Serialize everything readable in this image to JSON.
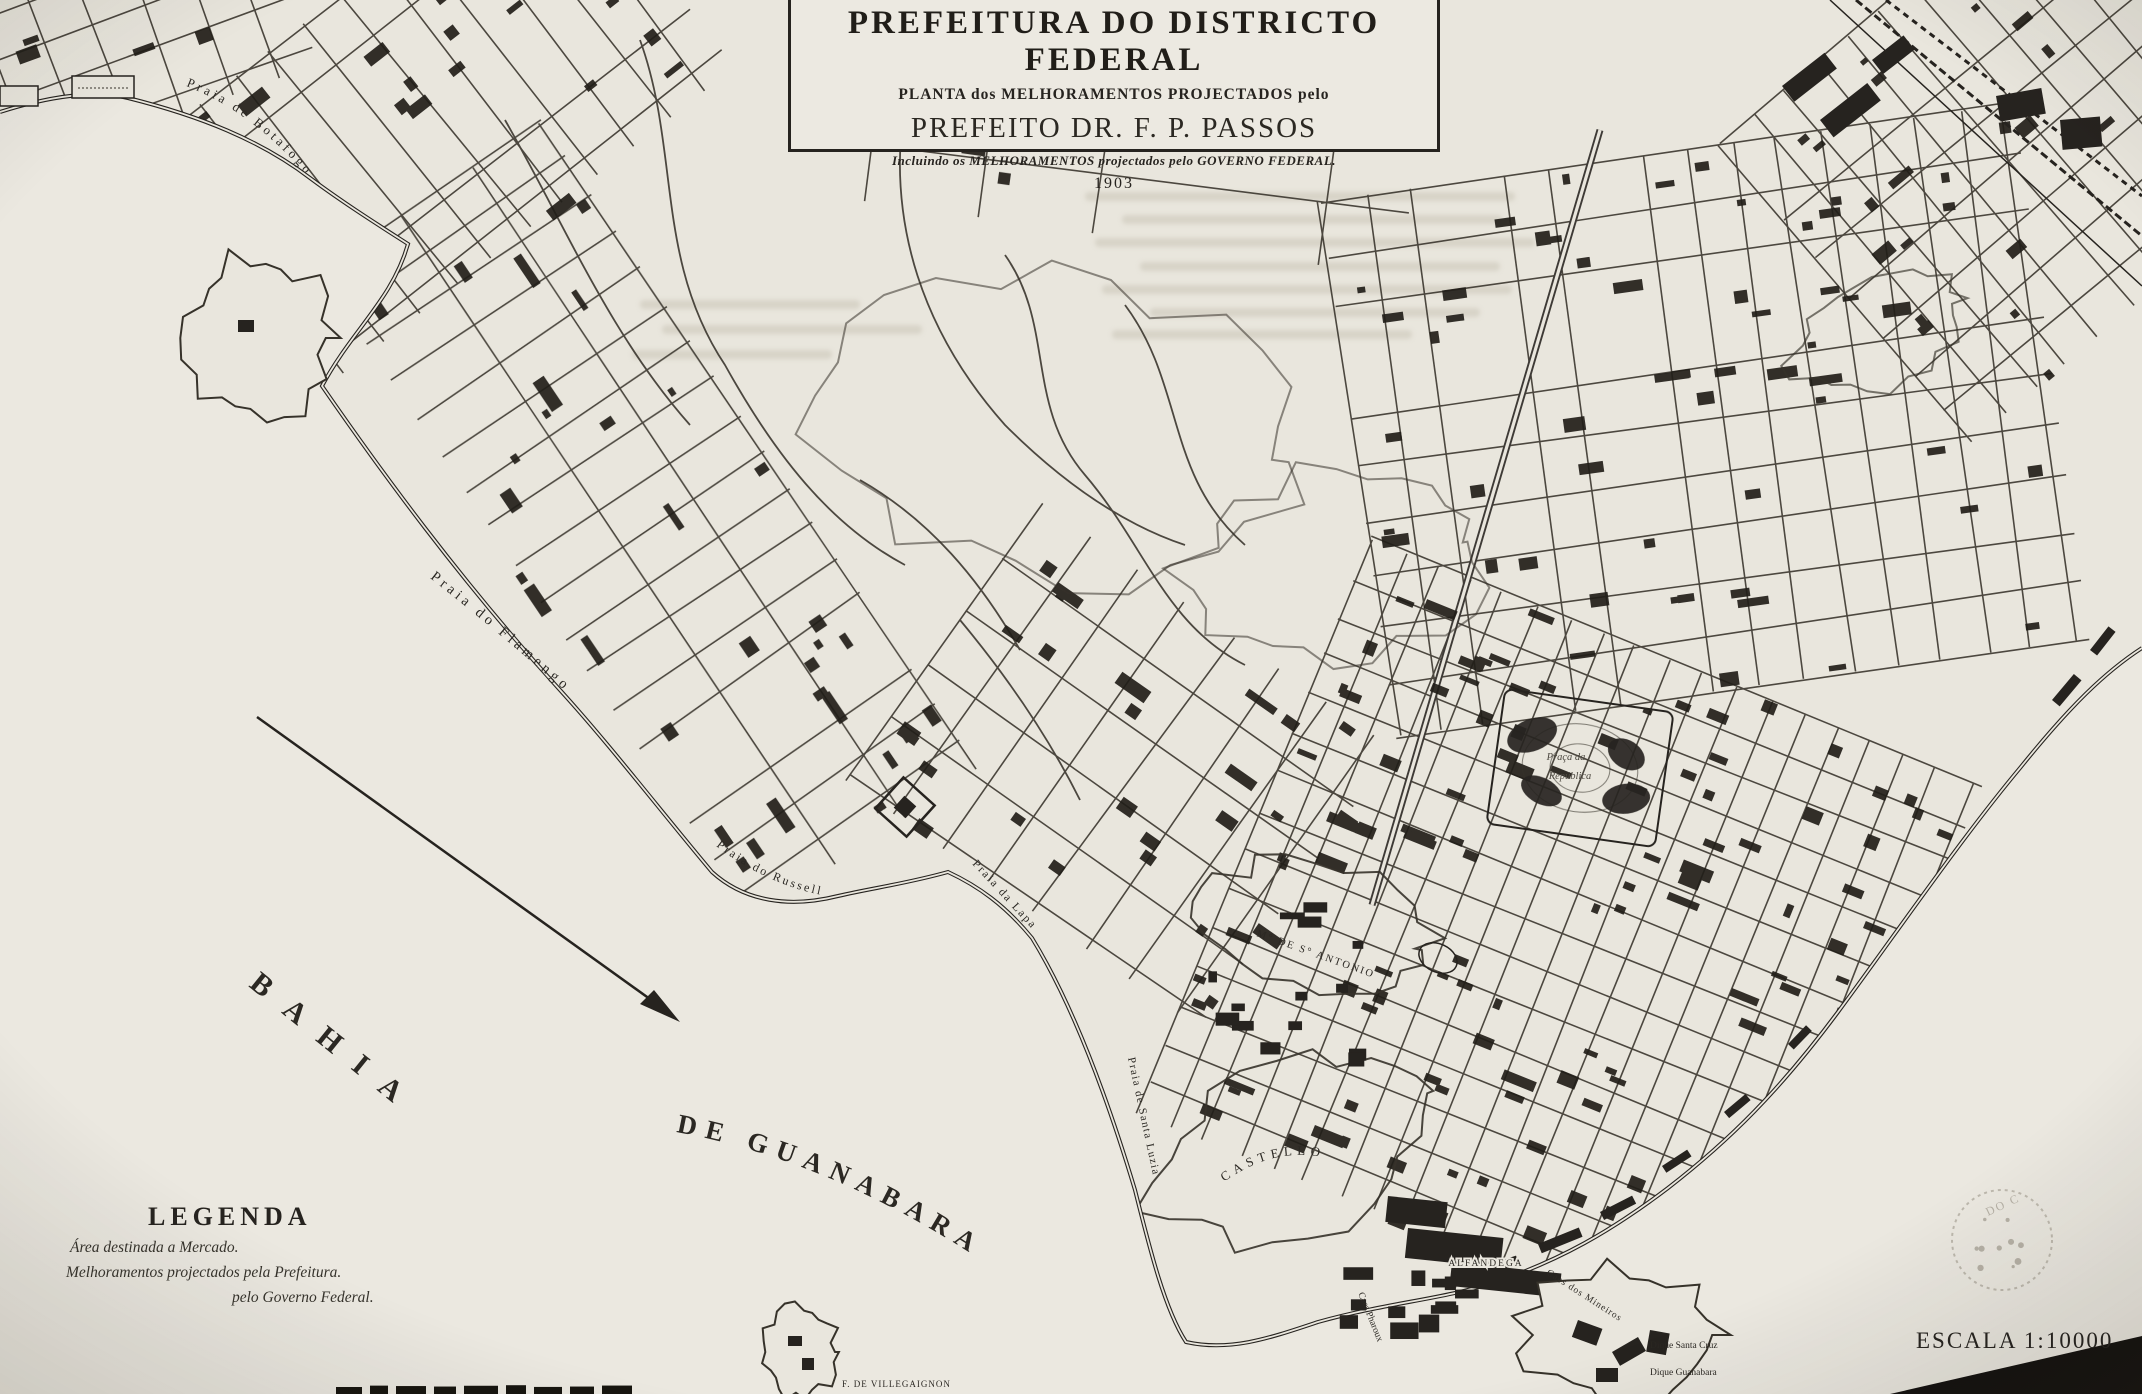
{
  "title_block": {
    "line1": "PREFEITURA DO DISTRICTO FEDERAL",
    "line2": "PLANTA dos MELHORAMENTOS PROJECTADOS pelo",
    "line3": "PREFEITO DR. F. P. PASSOS",
    "line4": "Incluindo os MELHORAMENTOS projectados pelo GOVERNO FEDERAL.",
    "year": "1903"
  },
  "legend": {
    "heading": "LEGENDA",
    "items": [
      "Área destinada a Mercado.",
      "Melhoramentos projectados pela Prefeitura.",
      "pelo Governo Federal."
    ]
  },
  "scale_label": "ESCALA 1:10000",
  "water_labels": [
    {
      "id": "bahia",
      "text": "BAHIA",
      "path": "M 248 986 L 414 1120",
      "size": 30,
      "ls": 22
    },
    {
      "id": "de-guanabara",
      "text": "DE   GUANABARA",
      "path": "M 676 1132 Q 832 1160 990 1266",
      "size": 27,
      "ls": 9
    }
  ],
  "map_labels": [
    {
      "id": "praia-de-botafogo",
      "text": "Praia de Botafogo",
      "path": "M 186 86 Q 280 122 354 240",
      "size": 13,
      "ls": 3.5
    },
    {
      "id": "praia-do-flamengo",
      "text": "Praia do Flamengo",
      "path": "M 430 578 Q 562 682 702 818",
      "size": 14.5,
      "ls": 4
    },
    {
      "id": "praia-do-russell",
      "text": "Praia do Russell",
      "path": "M 716 846 Q 800 910 904 898",
      "size": 12,
      "ls": 2.5
    },
    {
      "id": "praia-da-lapa",
      "text": "Praia da Lapa",
      "path": "M 972 864 L 1066 966",
      "size": 11.5,
      "ls": 2
    },
    {
      "id": "praia-de-santa-luzia",
      "text": "Praia de Santa Luzia",
      "path": "M 1128 1058 L 1180 1302",
      "size": 11,
      "ls": 1.5
    },
    {
      "id": "morro-do-castello",
      "text": "CASTELLO",
      "path": "M 1224 1182 Q 1288 1136 1354 1168",
      "size": 13,
      "ls": 5
    },
    {
      "id": "morro-de-santo-antonio",
      "text": "M° DE S° ANTONIO",
      "path": "M 1256 936 Q 1318 958 1374 978",
      "size": 10.5,
      "ls": 2
    },
    {
      "id": "praca-da-republica-line1",
      "text": "Praça da",
      "x": 1566,
      "y": 760,
      "size": 10.5,
      "italic": true,
      "fill": "#4e4a42"
    },
    {
      "id": "praca-da-republica-line2",
      "text": "República",
      "x": 1570,
      "y": 779,
      "size": 10.5,
      "italic": true,
      "fill": "#4e4a42"
    },
    {
      "id": "alfandega",
      "text": "ALFANDEGA",
      "x": 1486,
      "y": 1266,
      "size": 9.5,
      "ls": 2,
      "halo": true
    },
    {
      "id": "caes-dos-mineiros",
      "text": "Caes dos Mineiros",
      "path": "M 1546 1274 L 1630 1328",
      "size": 9.5,
      "ls": 1
    },
    {
      "id": "dique-santa-cruz",
      "text": "Dique Santa Cruz",
      "x": 1650,
      "y": 1348,
      "size": 9.5,
      "anchor": "start"
    },
    {
      "id": "dique-guanabara",
      "text": "Dique Guanabara",
      "x": 1650,
      "y": 1375,
      "size": 9.5,
      "anchor": "start"
    },
    {
      "id": "forte-villegaignon",
      "text": "F. DE VILLEGAIGNON",
      "x": 842,
      "y": 1387,
      "size": 9,
      "ls": 1,
      "anchor": "start"
    },
    {
      "id": "caes-pharoux",
      "text": "Caes Pharoux",
      "x": 1368,
      "y": 1318,
      "size": 9.5,
      "rot": 68
    }
  ],
  "stamp_text": "DO C",
  "colors": {
    "paper": "#e9e6dd",
    "ink": "#26231f",
    "street": "#36322a",
    "faded": "#8d8779"
  }
}
